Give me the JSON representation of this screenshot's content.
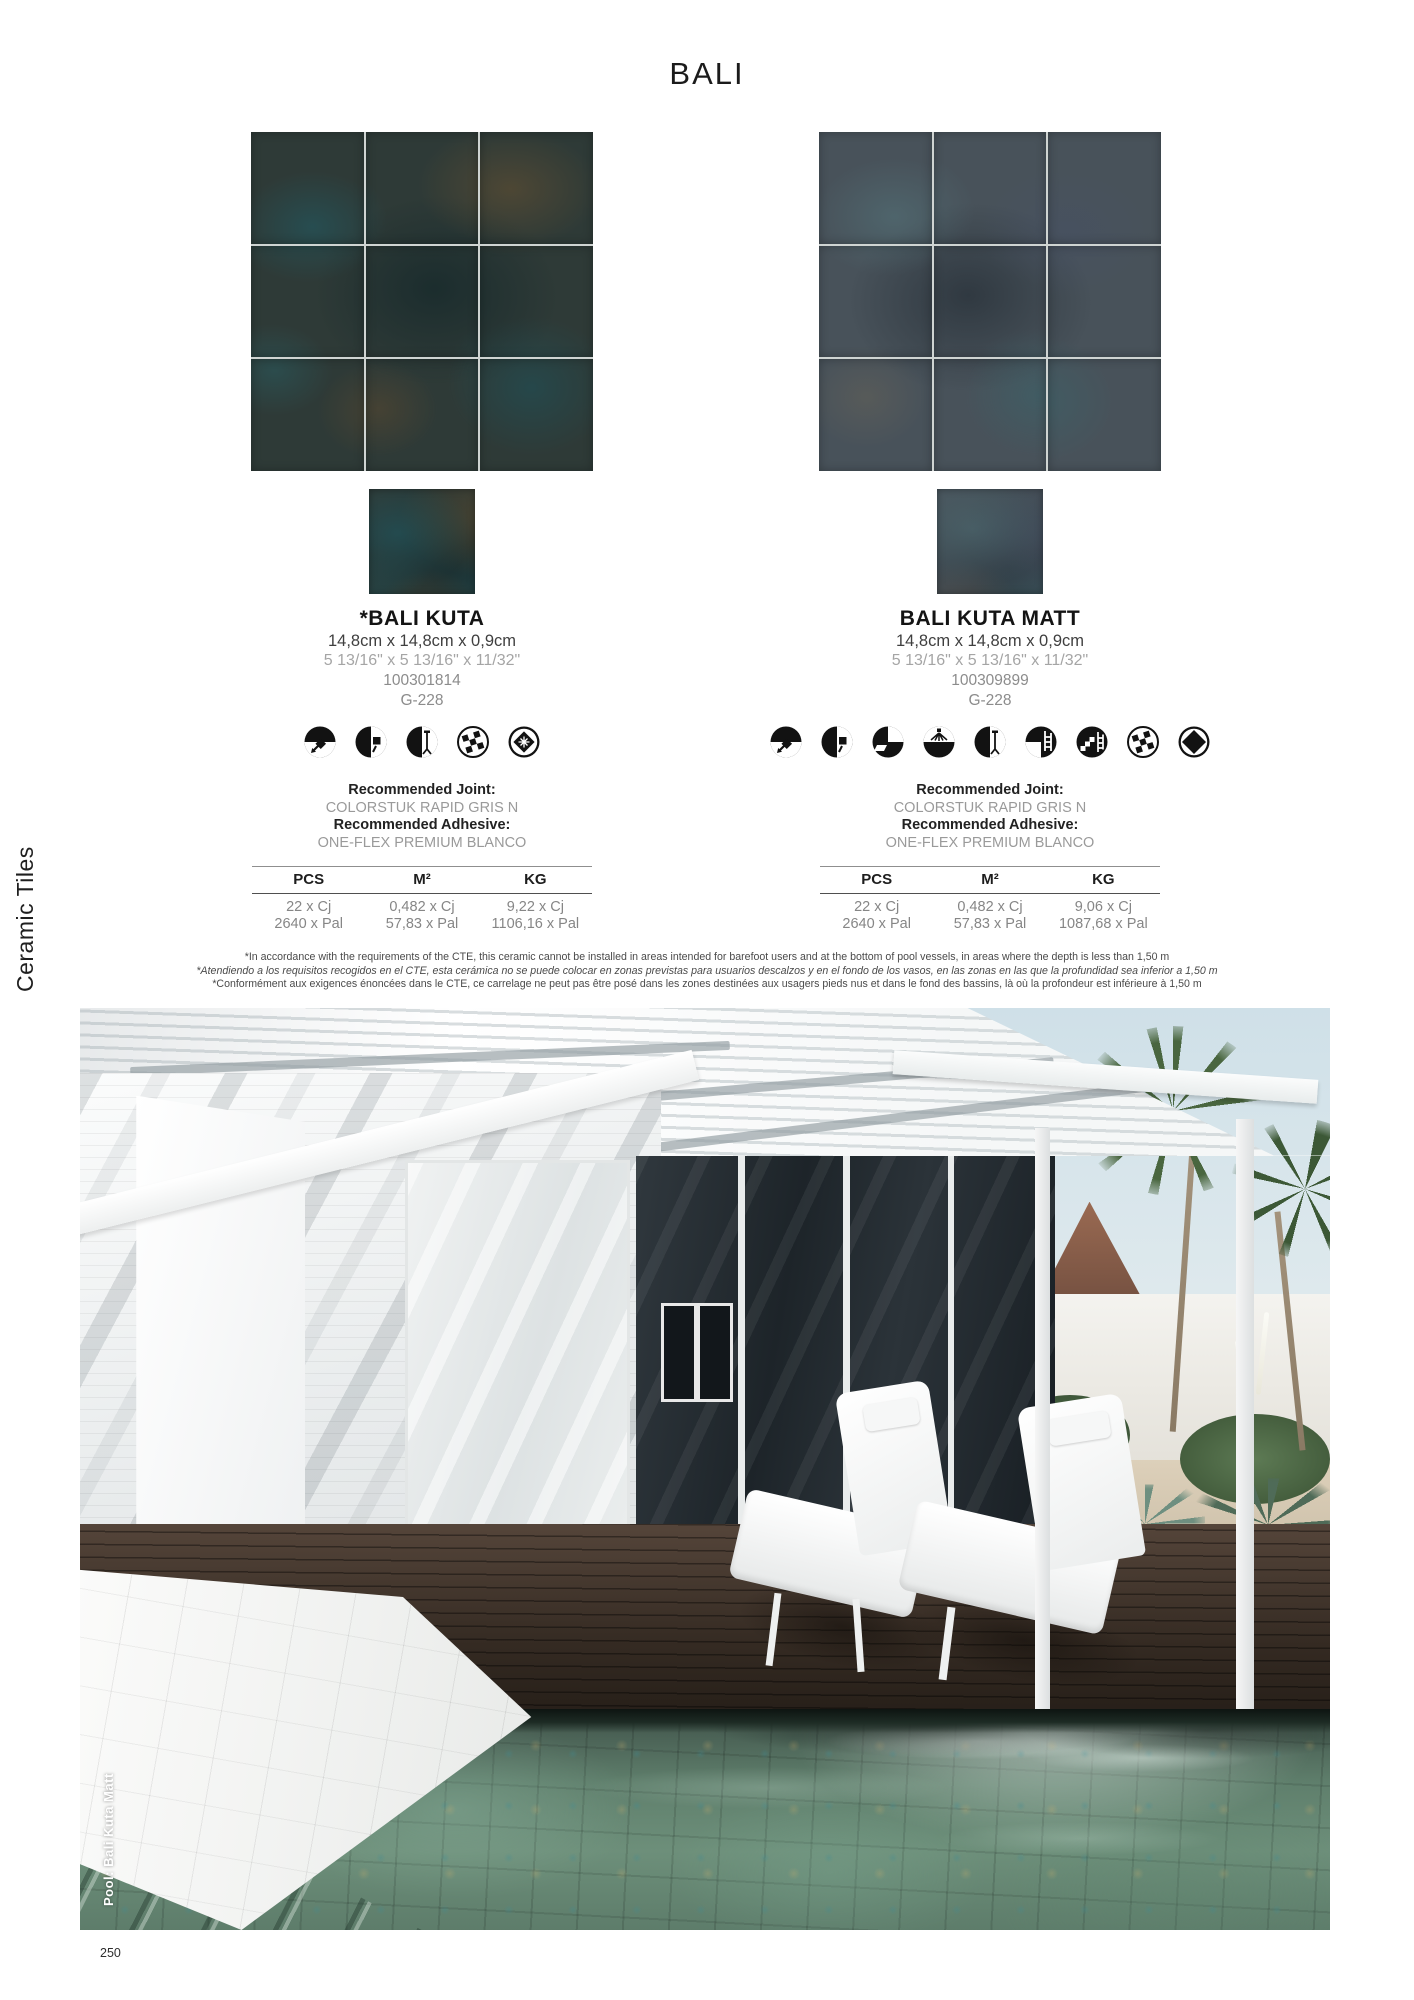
{
  "page": {
    "title": "BALI",
    "side_label": "Ceramic Tiles",
    "page_number": "250",
    "photo_caption": "Pool: Bali Kuta Matt"
  },
  "products": [
    {
      "name": "*BALI KUTA",
      "size_metric": "14,8cm x 14,8cm x 0,9cm",
      "size_imperial": "5 13/16\" x 5 13/16\" x 11/32\"",
      "sku": "100301814",
      "shade_code": "G-228",
      "icons": [
        "usage-floor",
        "usage-wall",
        "usage-shower-wall",
        "deco-mosaic",
        "finish-gloss"
      ],
      "joint_label": "Recommended Joint:",
      "joint_value": "COLORSTUK RAPID GRIS N",
      "adhesive_label": "Recommended Adhesive:",
      "adhesive_value": "ONE-FLEX PREMIUM BLANCO",
      "table": {
        "headers": [
          "PCS",
          "M²",
          "KG"
        ],
        "rows": [
          [
            "22 x Cj",
            "0,482 x Cj",
            "9,22 x Cj"
          ],
          [
            "2640 x Pal",
            "57,83 x Pal",
            "1106,16 x Pal"
          ]
        ]
      }
    },
    {
      "name": "BALI KUTA MATT",
      "size_metric": "14,8cm x 14,8cm x 0,9cm",
      "size_imperial": "5 13/16\" x 5 13/16\" x 11/32\"",
      "sku": "100309899",
      "shade_code": "G-228",
      "icons": [
        "usage-floor",
        "usage-wall",
        "usage-facade",
        "usage-shower-floor",
        "usage-shower-wall",
        "usage-pool-floor",
        "usage-pool-wall",
        "deco-mosaic",
        "finish-matt"
      ],
      "joint_label": "Recommended Joint:",
      "joint_value": "COLORSTUK RAPID GRIS N",
      "adhesive_label": "Recommended Adhesive:",
      "adhesive_value": "ONE-FLEX PREMIUM BLANCO",
      "table": {
        "headers": [
          "PCS",
          "M²",
          "KG"
        ],
        "rows": [
          [
            "22 x Cj",
            "0,482 x Cj",
            "9,06 x Cj"
          ],
          [
            "2640 x Pal",
            "57,83 x Pal",
            "1087,68 x Pal"
          ]
        ]
      }
    }
  ],
  "footnotes": [
    "*In accordance with the requirements of the CTE, this ceramic cannot be installed in areas intended for barefoot users and at the bottom of pool vessels, in areas where the depth is less than 1,50 m",
    "*Atendiendo a los requisitos recogidos en el CTE, esta cerámica no se puede colocar en zonas previstas para usuarios descalzos y en el fondo de los vasos, en las zonas en las que la profundidad sea inferior a 1,50 m",
    "*Conformément aux exigences énoncées dans le CTE, ce carrelage ne peut pas être posé dans les zones destinées aux usagers pieds nus et dans le fond des bassins, là où la profondeur est inférieure à 1,50 m"
  ],
  "colors": {
    "ink": "#1d1d1d",
    "muted_gray": "#9a9a9a",
    "kuta_tile_base": "#2e3a37",
    "kuta_matt_tile_base": "#48525a",
    "pool_water": "#5e7a6d",
    "deck_wood": "#342a22"
  }
}
